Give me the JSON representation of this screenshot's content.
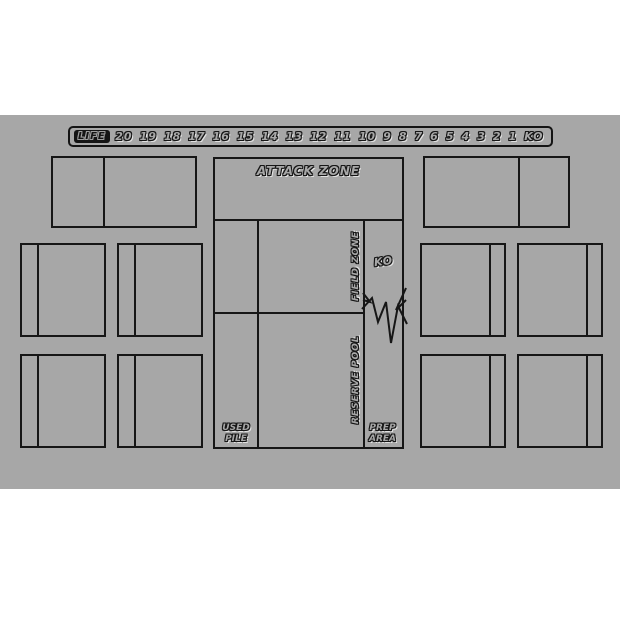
{
  "mat": {
    "background_color": "#a7a7a7",
    "page_background_color": "#ffffff",
    "line_color": "#161616"
  },
  "life_bar": {
    "label": "LIFE",
    "values": [
      "20",
      "19",
      "18",
      "17",
      "16",
      "15",
      "14",
      "13",
      "12",
      "11",
      "10",
      "9",
      "8",
      "7",
      "6",
      "5",
      "4",
      "3",
      "2",
      "1",
      "KO"
    ]
  },
  "board": {
    "attack_zone_label": "ATTACK ZONE",
    "field_zone_label": "FIELD ZONE",
    "reserve_pool_label": "RESERVE POOL",
    "ko_label": "KO",
    "used_pile_line1": "USED",
    "used_pile_line2": "PILE",
    "prep_area_line1": "PREP",
    "prep_area_line2": "AREA"
  }
}
